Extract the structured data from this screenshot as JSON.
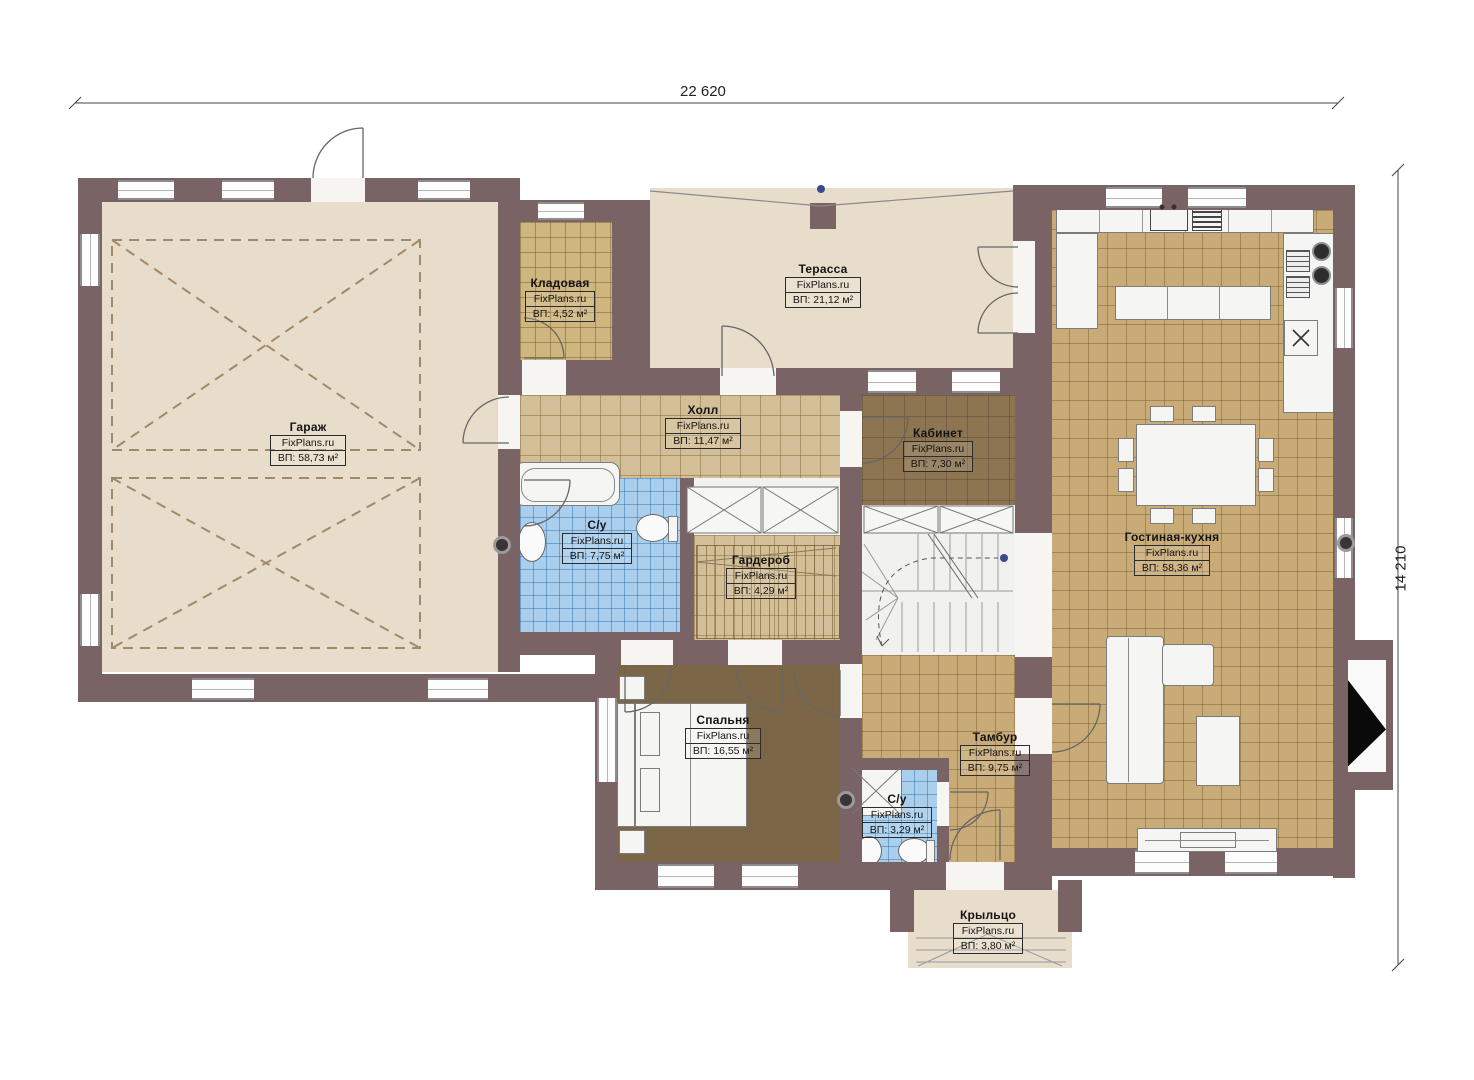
{
  "plan": {
    "dimension_top": "22 620",
    "dimension_right": "14 210",
    "brand": "FixPlans.ru",
    "colors": {
      "wall": "#7a6365",
      "floor_beige": "#e8ddcb",
      "floor_tile_tan": "#d3bf97",
      "floor_tile_gold": "#c9ab77",
      "floor_office": "#8d7551",
      "floor_bedroom": "#7b6747",
      "floor_tile_blue": "#a9cfec",
      "floor_white": "#f1f1ef"
    },
    "rooms": [
      {
        "id": "garage",
        "name": "Гараж",
        "site": "FixPlans.ru",
        "area": "ВП: 58,73 м²"
      },
      {
        "id": "storage",
        "name": "Кладовая",
        "site": "FixPlans.ru",
        "area": "ВП: 4,52 м²"
      },
      {
        "id": "terrace",
        "name": "Терасса",
        "site": "FixPlans.ru",
        "area": "ВП: 21,12 м²"
      },
      {
        "id": "hall",
        "name": "Холл",
        "site": "FixPlans.ru",
        "area": "ВП: 11,47 м²"
      },
      {
        "id": "office",
        "name": "Кабинет",
        "site": "FixPlans.ru",
        "area": "ВП: 7,30 м²"
      },
      {
        "id": "bathroom-1",
        "name": "С/у",
        "site": "FixPlans.ru",
        "area": "ВП: 7,75 м²"
      },
      {
        "id": "wardrobe",
        "name": "Гардероб",
        "site": "FixPlans.ru",
        "area": "ВП: 4,29 м²"
      },
      {
        "id": "living-kitchen",
        "name": "Гостиная-кухня",
        "site": "FixPlans.ru",
        "area": "ВП: 58,36 м²"
      },
      {
        "id": "bedroom",
        "name": "Спальня",
        "site": "FixPlans.ru",
        "area": "ВП: 16,55 м²"
      },
      {
        "id": "vestibule",
        "name": "Тамбур",
        "site": "FixPlans.ru",
        "area": "ВП: 9,75 м²"
      },
      {
        "id": "bathroom-2",
        "name": "С/у",
        "site": "FixPlans.ru",
        "area": "ВП: 3,29 м²"
      },
      {
        "id": "porch",
        "name": "Крыльцо",
        "site": "FixPlans.ru",
        "area": "ВП: 3,80 м²"
      }
    ]
  }
}
